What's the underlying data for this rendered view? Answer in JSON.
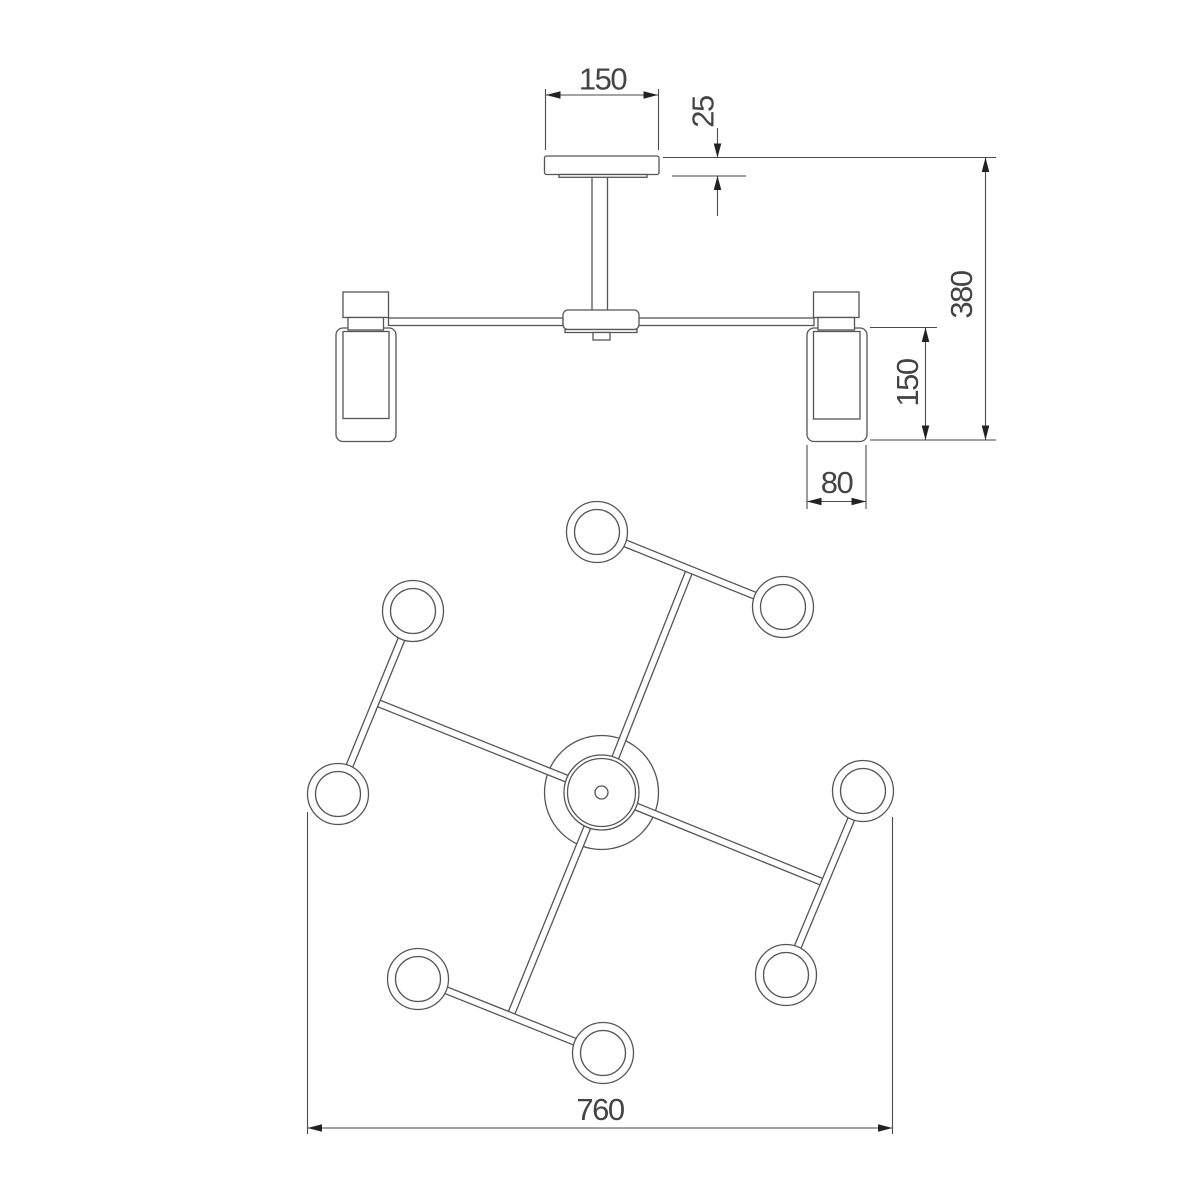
{
  "drawing": {
    "kind": "luminaire technical drawing",
    "views": {
      "side_view_label": "side elevation",
      "plan_view_label": "bottom plan"
    },
    "dimensions": {
      "canopy_width": "150",
      "canopy_height": "25",
      "overall_height": "380",
      "shade_height": "150",
      "shade_width": "80",
      "overall_width": "760"
    },
    "colors": {
      "background": "#ffffff",
      "line": "#555555",
      "dimension_line": "#4a4a4a",
      "arrow": "#222222",
      "text": "#444444",
      "shade_dots": "#c0c0c0"
    }
  }
}
